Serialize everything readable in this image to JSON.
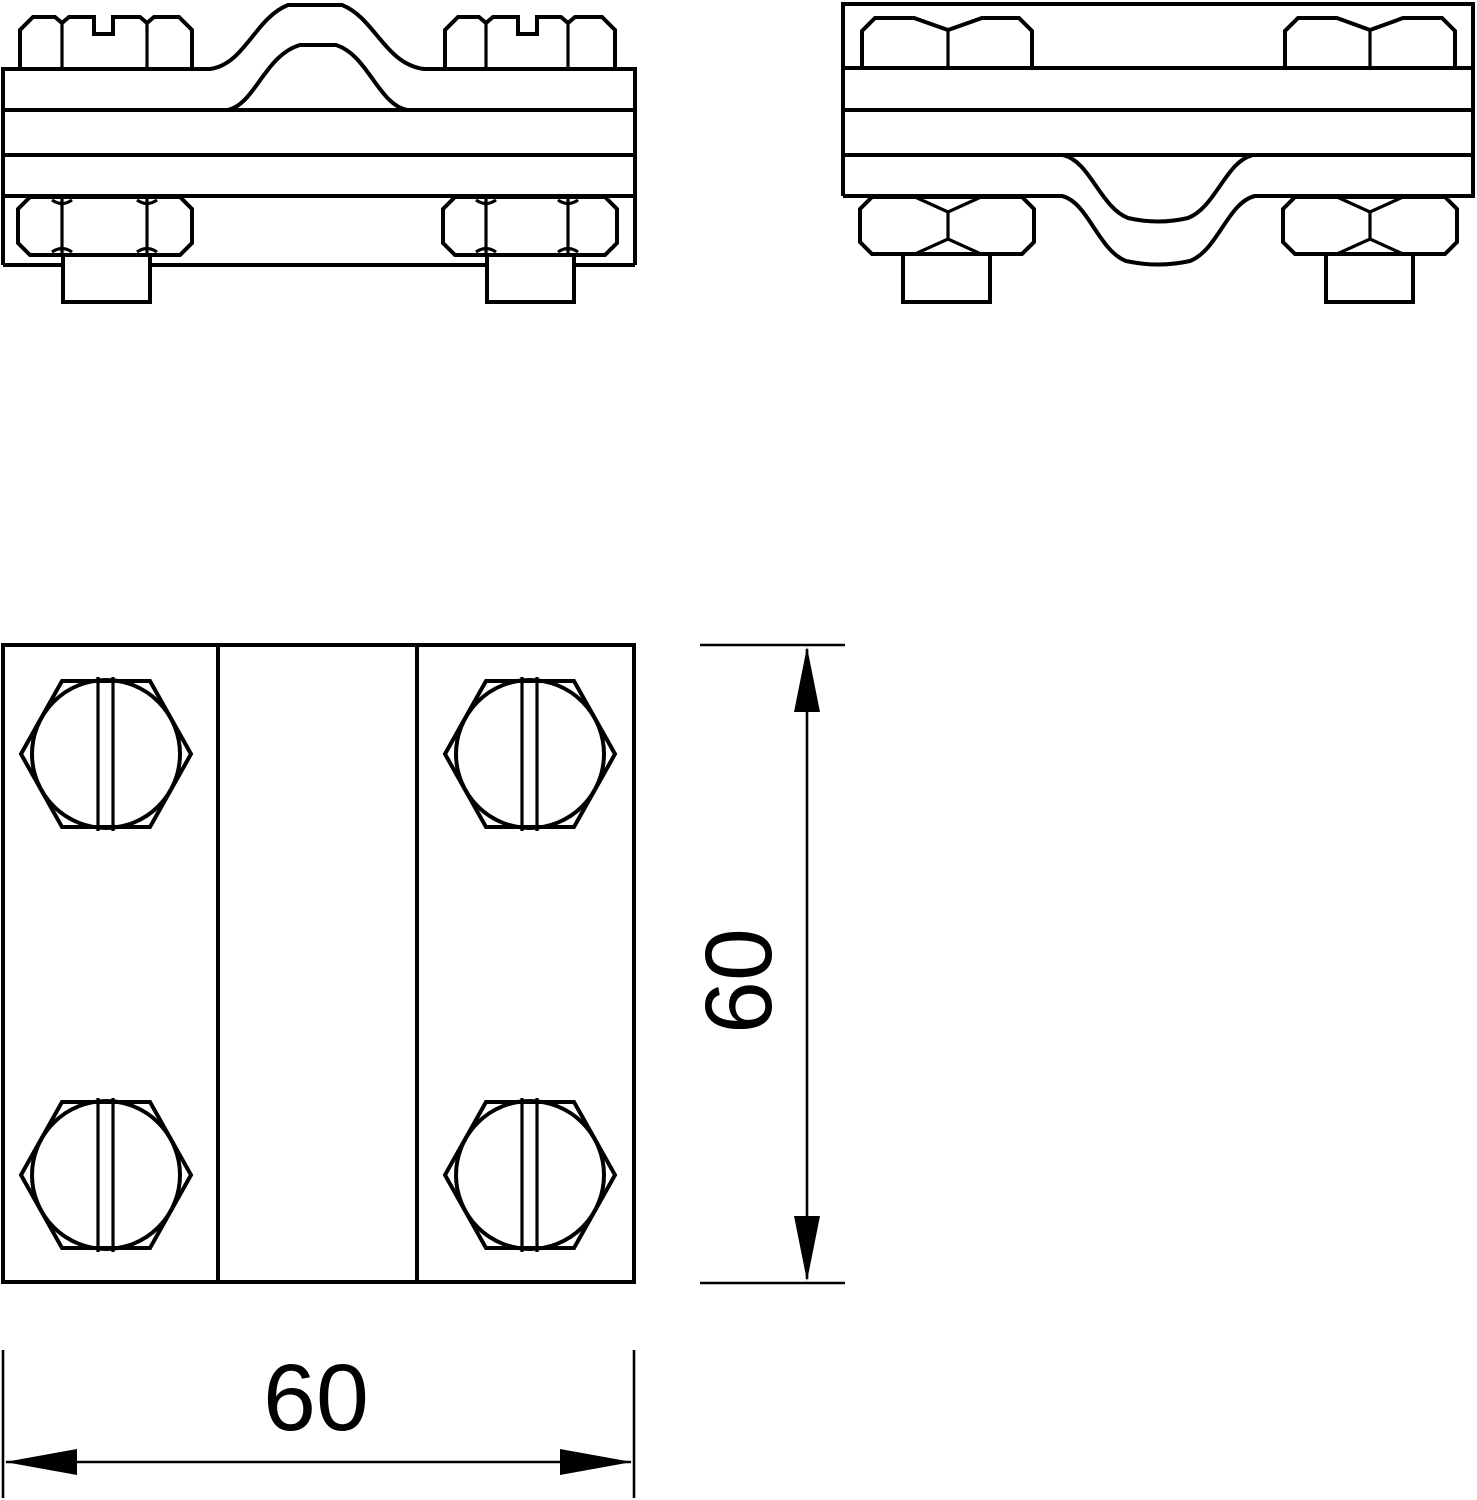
{
  "drawing": {
    "kind": "technical line drawing, three orthographic views of a cross/parallel connector clamp with four slotted hex bolts",
    "colors": {
      "line": "#000000",
      "background": "#ffffff"
    }
  },
  "dimensions": {
    "width_label": "60",
    "height_label": "60"
  }
}
